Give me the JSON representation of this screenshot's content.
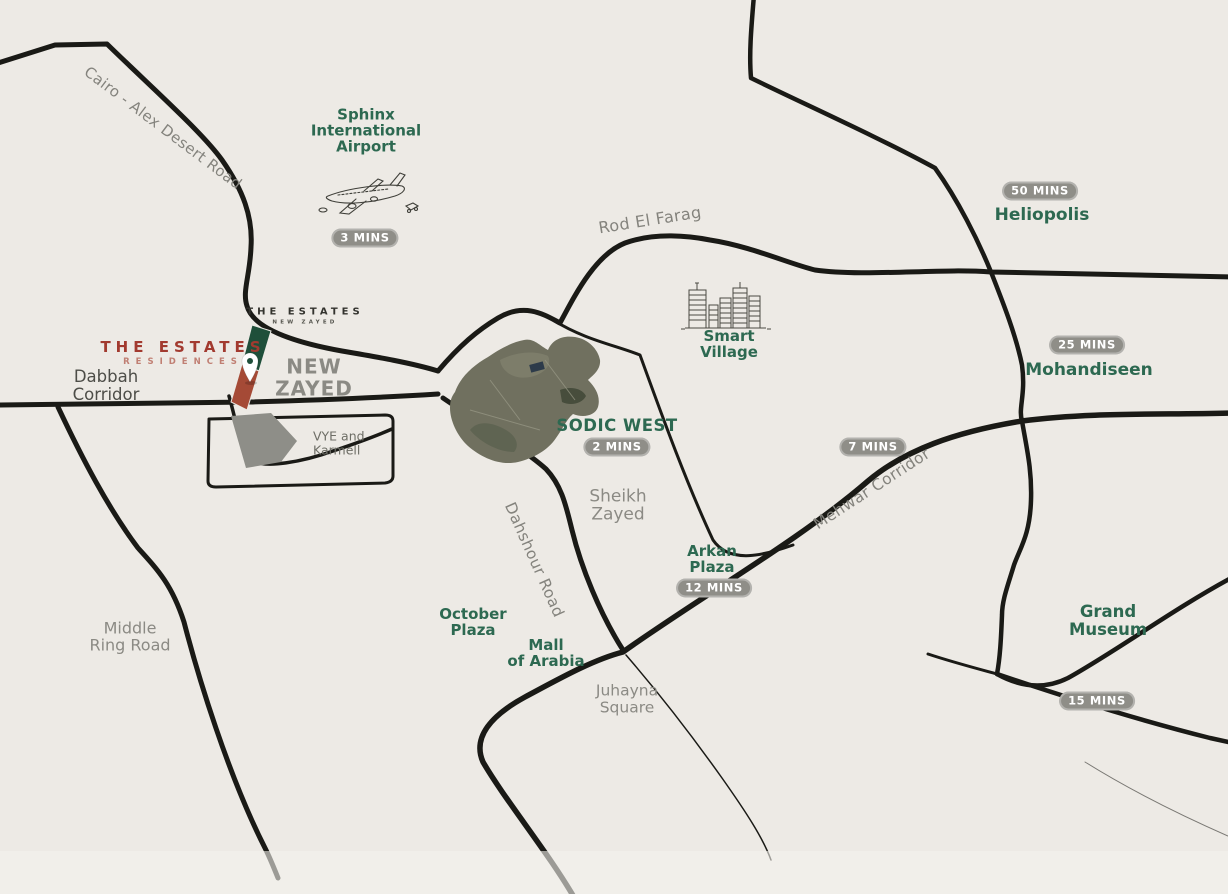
{
  "colors": {
    "background": "#edeae5",
    "road": "#1a1a16",
    "accent_green": "#2d6951",
    "label_gray": "#8b8a84",
    "label_dark_gray": "#4d4d48",
    "badge_bg": "#8f8e88",
    "badge_text": "#ffffff",
    "logo_red": "#a23a2f",
    "parcel_green": "#1f4f3a",
    "parcel_red": "#a54a36"
  },
  "brand": {
    "residences_logo": {
      "line1": "THE ESTATES",
      "line2": "RESIDENCES"
    },
    "site_logo": {
      "line1": "THE ESTATES",
      "line2": "NEW ZAYED"
    }
  },
  "roads": {
    "cairo_alex": "Cairo - Alex Desert Road",
    "rod_el_farag": "Rod El Farag",
    "mehwar": {
      "label": "Mehwar Corridor",
      "time": "7 MINS"
    },
    "dahshour": "Dahshour Road",
    "dabbah": {
      "line1": "Dabbah",
      "line2": "Corridor"
    },
    "middle_ring": {
      "line1": "Middle",
      "line2": "Ring Road"
    }
  },
  "places": {
    "sphinx_airport": {
      "line1": "Sphinx",
      "line2": "International",
      "line3": "Airport",
      "time": "3 MINS"
    },
    "heliopolis": {
      "name": "Heliopolis",
      "time": "50 MINS"
    },
    "smart_village": {
      "line1": "Smart",
      "line2": "Village"
    },
    "mohandiseen": {
      "name": "Mohandiseen",
      "time": "25 MINS"
    },
    "new_zayed": {
      "line1": "NEW",
      "line2": "ZAYED"
    },
    "vye_karmell": {
      "line1": "VYE and",
      "line2": "Karmell"
    },
    "sodic_west": {
      "name": "SODIC WEST",
      "time": "2 MINS"
    },
    "sheikh_zayed": {
      "line1": "Sheikh",
      "line2": "Zayed"
    },
    "arkan_plaza": {
      "line1": "Arkan",
      "line2": "Plaza",
      "time": "12 MINS"
    },
    "october_plaza": {
      "line1": "October",
      "line2": "Plaza"
    },
    "mall_of_arabia": {
      "line1": "Mall",
      "line2": "of Arabia"
    },
    "juhayna_square": {
      "line1": "Juhayna",
      "line2": "Square"
    },
    "grand_museum": {
      "line1": "Grand",
      "line2": "Museum",
      "time": "15 MINS"
    }
  }
}
